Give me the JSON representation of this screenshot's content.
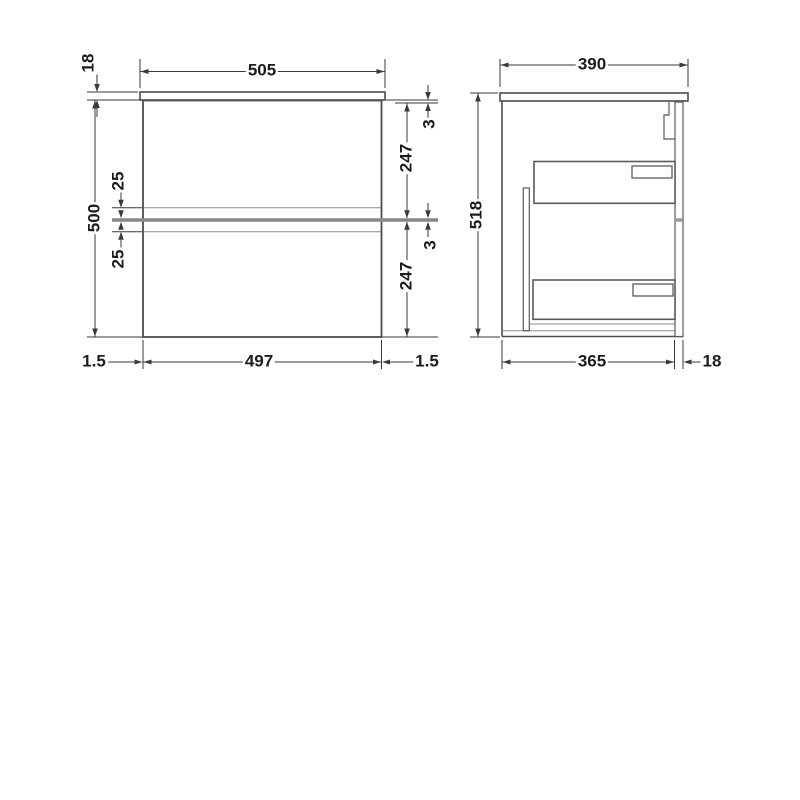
{
  "front_view": {
    "countertop_width": "505",
    "countertop_thickness": "18",
    "cabinet_height": "500",
    "groove_offset_top": "25",
    "groove_offset_bottom": "25",
    "top_gap": "3",
    "upper_drawer_height": "247",
    "mid_gap": "3",
    "lower_drawer_height": "247",
    "side_gap_left": "1.5",
    "drawer_front_width": "497",
    "side_gap_right": "1.5"
  },
  "side_view": {
    "countertop_depth": "390",
    "total_height": "518",
    "cabinet_depth": "365",
    "front_panel_thickness": "18"
  },
  "colors": {
    "background": "#ffffff",
    "outline": "#4d4d4d",
    "thin_line": "#8a8a8a",
    "gap_band": "#878787",
    "dimension_line": "#3a3a3a",
    "text": "#1c1c1c"
  }
}
